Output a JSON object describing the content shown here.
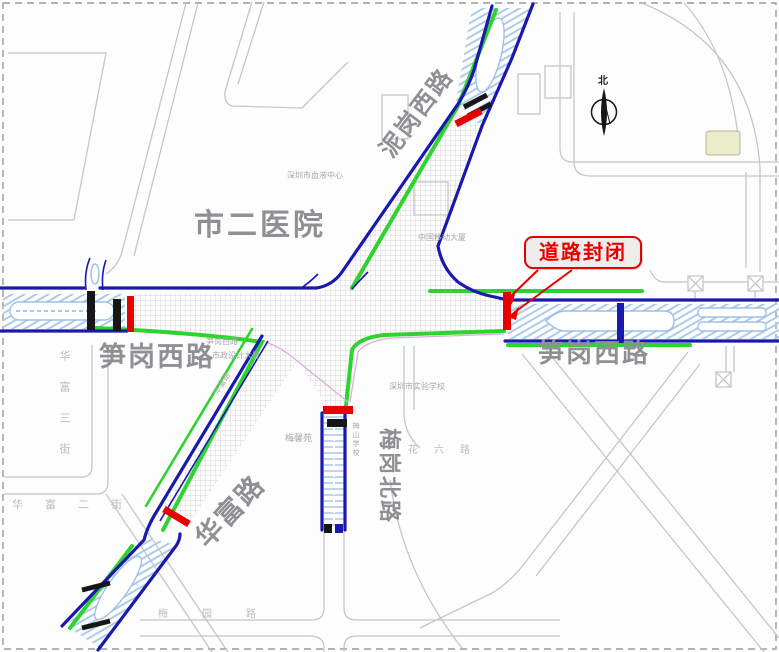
{
  "map": {
    "colors": {
      "road_blue": "#1b18ae",
      "road_green": "#2ed42e",
      "closed_red": "#e80000",
      "hatch_gray": "#c9c9c9",
      "outline_gray": "#c6c6ca",
      "label_gray": "#8f8f94",
      "minor_gray": "#a8a8ac",
      "stripe_blue": "#aecbec",
      "median_edge": "#9fc0e6",
      "building_beige": "#e9edca",
      "ink": "#161616",
      "pink": "#dcaede",
      "badge_bg": "#efecec"
    },
    "labels": {
      "hospital": "市二医院",
      "nigang_road": "泥岗西路",
      "sungang_road_left": "笋岗西路",
      "sungang_road_right": "笋岗西路",
      "huafu_road": "华富路",
      "meigang_road": "梅岗北路",
      "closure_badge": "道路封闭",
      "north": "北"
    },
    "minor_labels": {
      "blood_center": "深圳市血液中心",
      "mobile_building": "中国移动大厦",
      "sungang_small": "笋岗西路",
      "design_institute": "市政设计大厦",
      "experimental_school": "深圳市实验学校",
      "meixin_court": "梅馨苑",
      "meishan_school": "梅山学校",
      "huafu_3rd_street": "华富三街",
      "huafu_2nd_street": "华富二街",
      "meiyuan_road": "梅园路",
      "hualiu_road": "花六路",
      "huafu_small": "华富路"
    }
  }
}
